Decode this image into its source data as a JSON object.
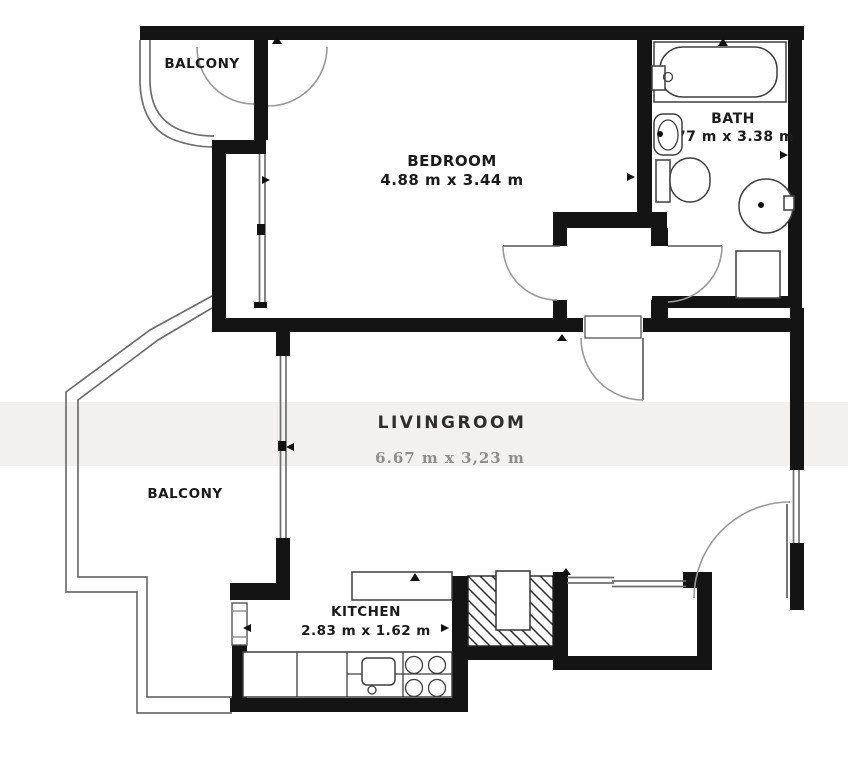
{
  "plan": {
    "type": "apartment-floor-plan",
    "colors": {
      "background": "#ffffff",
      "wall": "#141414",
      "thin_line": "#6e6e6e",
      "door_arc": "#9a9a9a",
      "label": "#1b1b1b",
      "livingroom_dims": "#8d8d8d",
      "watermark_band": "#f2f1ef"
    },
    "rooms": {
      "balcony_top": {
        "label": "BALCONY"
      },
      "bedroom": {
        "label": "BEDROOM",
        "dims": "4.88 m x 3.44 m"
      },
      "bath": {
        "label": "BATH",
        "dims": "1.77 m x 3.38 m"
      },
      "livingroom": {
        "label": "LIVINGROOM",
        "dims": "6.67 m x 3,23 m"
      },
      "balcony_left": {
        "label": "BALCONY"
      },
      "kitchen": {
        "label": "KITCHEN",
        "dims": "2.83 m x 1.62 m"
      }
    },
    "fixtures": [
      "bathtub",
      "bathtub-faucet",
      "wash-basin",
      "toilet",
      "washing-machine",
      "shower-tray",
      "ventilation-shaft",
      "kitchen-top-counter",
      "kitchen-counter",
      "kitchen-sink",
      "cooktop-burners"
    ],
    "openings": [
      "balcony-double-door",
      "hall-bedroom-door",
      "hall-bath-door",
      "hall-livingroom-door",
      "entrance-door",
      "bedroom-west-window",
      "livingroom-west-window",
      "livingroom-east-window",
      "livingroom-south-window",
      "kitchen-west-window"
    ]
  }
}
